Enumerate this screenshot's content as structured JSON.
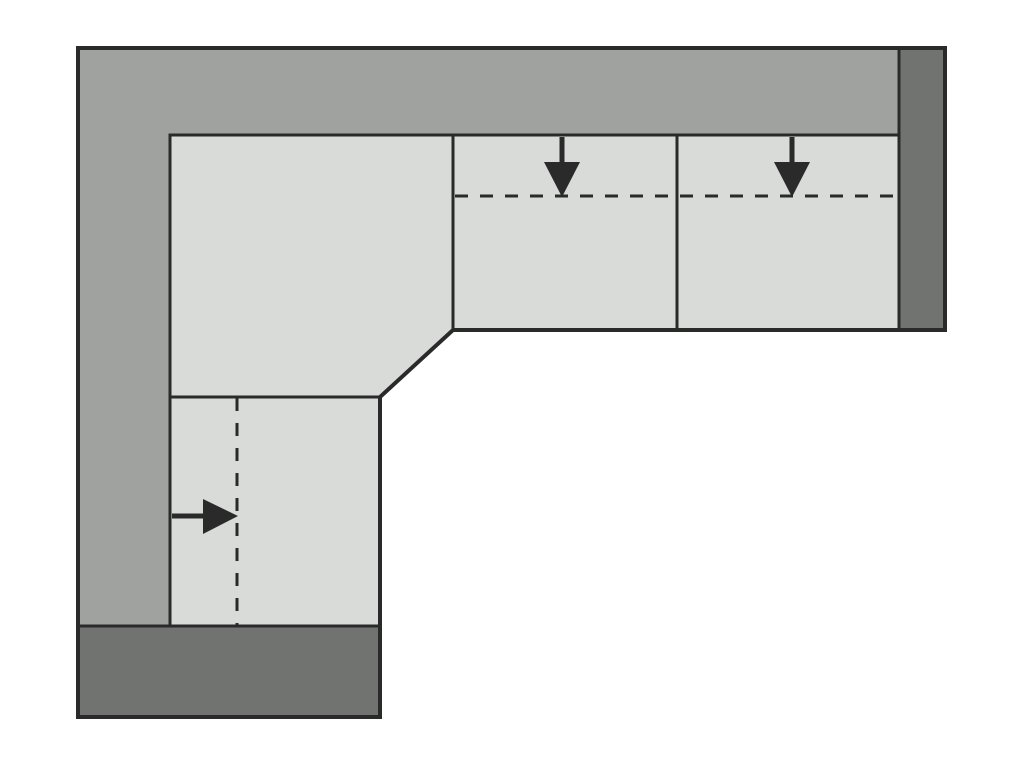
{
  "diagram": {
    "name": "corner-sofa-top-view-schematic",
    "canvas": {
      "width": 1024,
      "height": 768,
      "background": "#ffffff"
    },
    "colors": {
      "backrest": "#a0a2a0",
      "seat": "#d9dbd9",
      "armrest": "#717371",
      "outline": "#2a2a2a",
      "arrow": "#2a2a2a"
    },
    "dash_pattern": "13 12",
    "shapes": {
      "backrest_band": {
        "points": "78,48 899,48 899,135 170,135 170,626 78,626"
      },
      "corner_seat": {
        "points": "170,135 453,135 453,330 380,397 170,397"
      },
      "bottom_seat": {
        "x": 170,
        "y": 397,
        "width": 210,
        "height": 229
      },
      "right_seat_1": {
        "x": 453,
        "y": 135,
        "width": 224,
        "height": 195
      },
      "right_seat_2": {
        "x": 677,
        "y": 135,
        "width": 222,
        "height": 195
      },
      "right_armrest": {
        "x": 899,
        "y": 48,
        "width": 46,
        "height": 282
      },
      "bottom_armrest": {
        "x": 78,
        "y": 626,
        "width": 302,
        "height": 91
      },
      "outer_outline": {
        "points": "78,48 945,48 945,330 453,330 380,397 380,717 78,717"
      }
    },
    "dashed_lines": {
      "right_seats_depth": {
        "x1": 455,
        "y1": 196,
        "x2": 897,
        "y2": 196
      },
      "bottom_seat_width": {
        "x1": 237,
        "y1": 398,
        "x2": 237,
        "y2": 625
      }
    },
    "arrows": {
      "down_1": {
        "stem": {
          "x1": 562,
          "y1": 137,
          "x2": 562,
          "y2": 170
        },
        "head": {
          "points": "544,162 580,162 562,197"
        }
      },
      "down_2": {
        "stem": {
          "x1": 792,
          "y1": 137,
          "x2": 792,
          "y2": 170
        },
        "head": {
          "points": "774,162 810,162 792,197"
        }
      },
      "right_1": {
        "stem": {
          "x1": 172,
          "y1": 516,
          "x2": 210,
          "y2": 516
        },
        "head": {
          "points": "203,499 203,534 238,516"
        }
      }
    }
  }
}
